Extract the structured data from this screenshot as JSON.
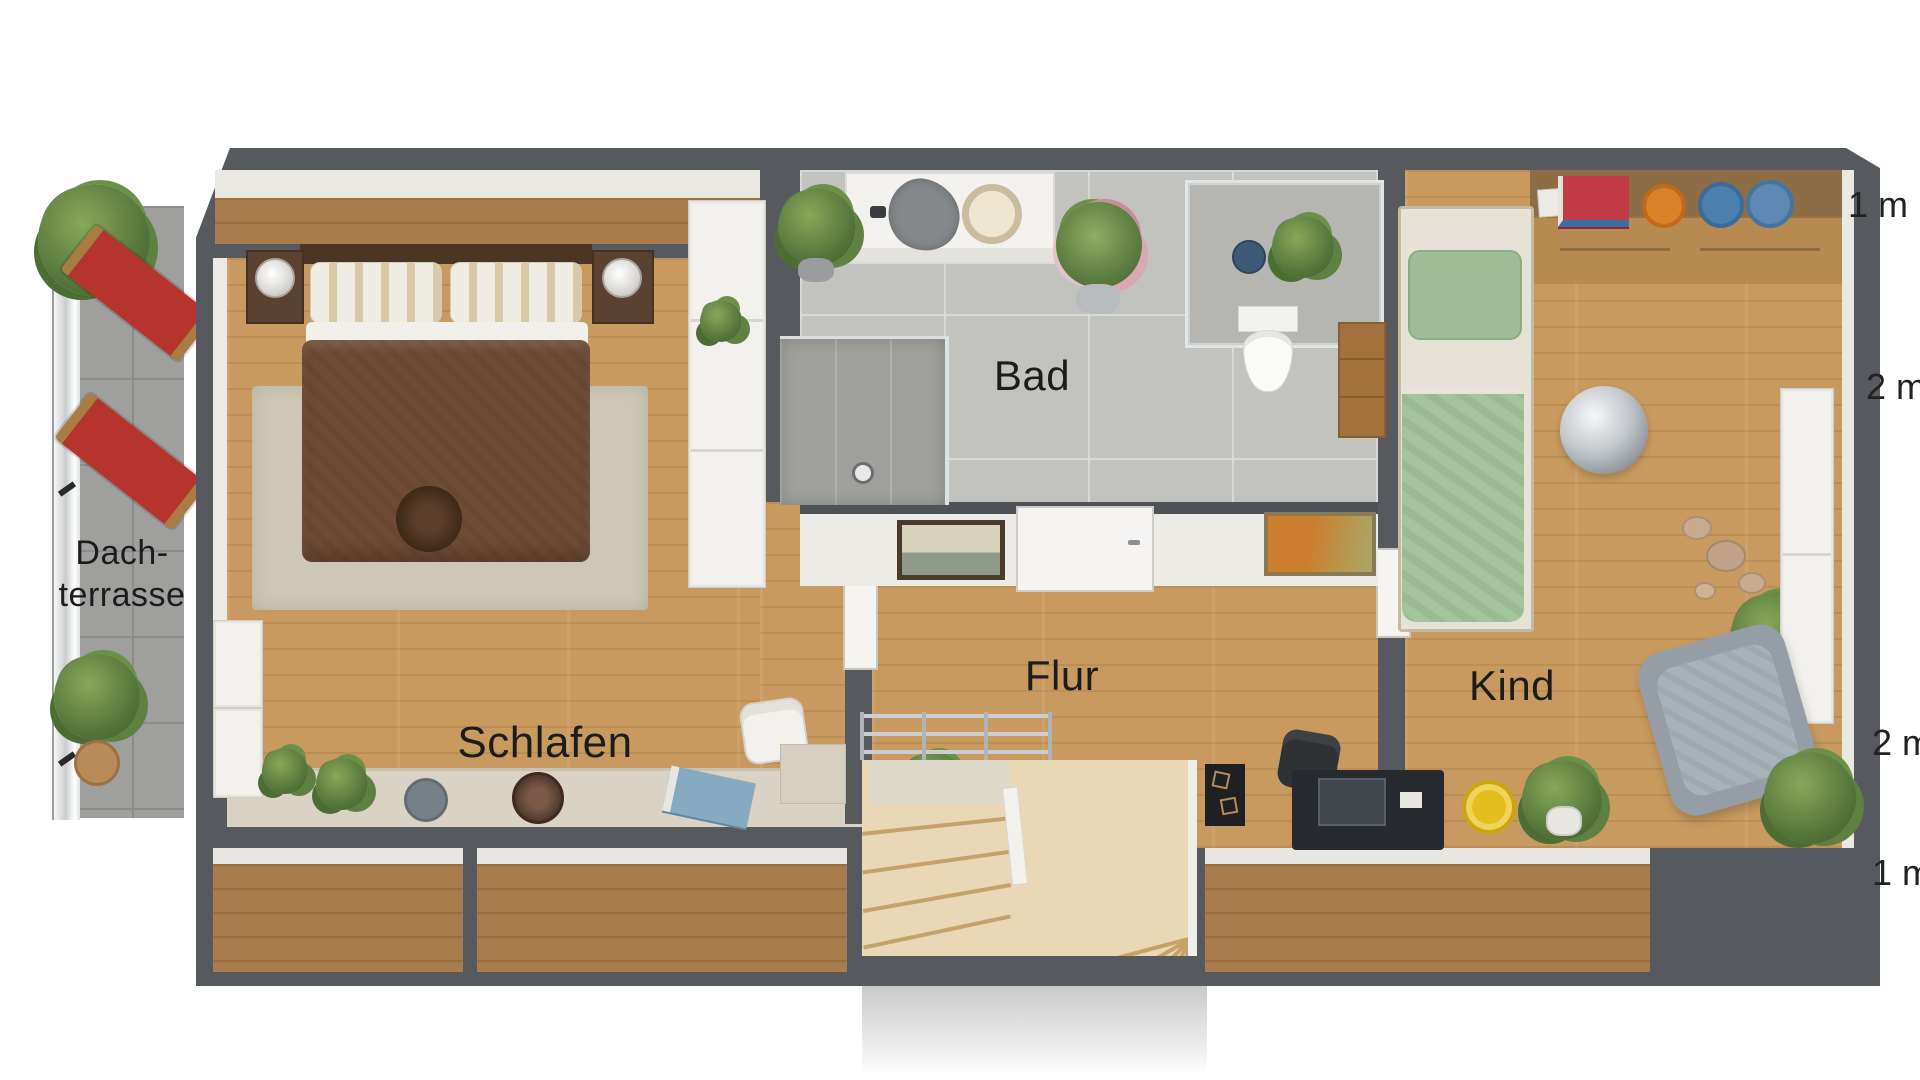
{
  "floorplan": {
    "rooms": {
      "schlafen": {
        "label": "Schlafen"
      },
      "bad": {
        "label": "Bad"
      },
      "flur": {
        "label": "Flur"
      },
      "kind": {
        "label": "Kind"
      },
      "dachterrasse": {
        "line1": "Dach-",
        "line2": "terrasse"
      }
    },
    "measurements": [
      "1 m",
      "2 m",
      "2 m",
      "1 m"
    ],
    "colors": {
      "wall": "#56595d",
      "wood_floor": "#c89a5f",
      "eaves_wood": "#a87c4c",
      "bathroom_tile": "#c2c3bf",
      "terrace_tile": "#9f9f9d",
      "deckchair_red": "#b5342e",
      "kids_bed_green": "#a3c49c",
      "duvet_brown": "#6e4c34",
      "stair_wood": "#ead7b6",
      "label_text": "#1c1c1c"
    },
    "furniture": {
      "dachterrasse": [
        "two red deck chairs",
        "potted plants",
        "glass railing"
      ],
      "schlafen": [
        "double bed",
        "nightstands with lamps",
        "rug",
        "wardrobe",
        "dressers",
        "sideboard ledge with plants",
        "desk chair"
      ],
      "bad": [
        "vanity with towel and basket",
        "walk-in shower",
        "glass shower area",
        "toilet",
        "wooden cabinet",
        "plants"
      ],
      "flur": [
        "stair railing",
        "winder staircase",
        "framed pictures",
        "door"
      ],
      "kind": [
        "single bed with green bedding",
        "sideboard with books and bowls",
        "mirror ball lamp",
        "desk with chair and computer",
        "armchair",
        "plants",
        "white cabinets"
      ]
    }
  }
}
